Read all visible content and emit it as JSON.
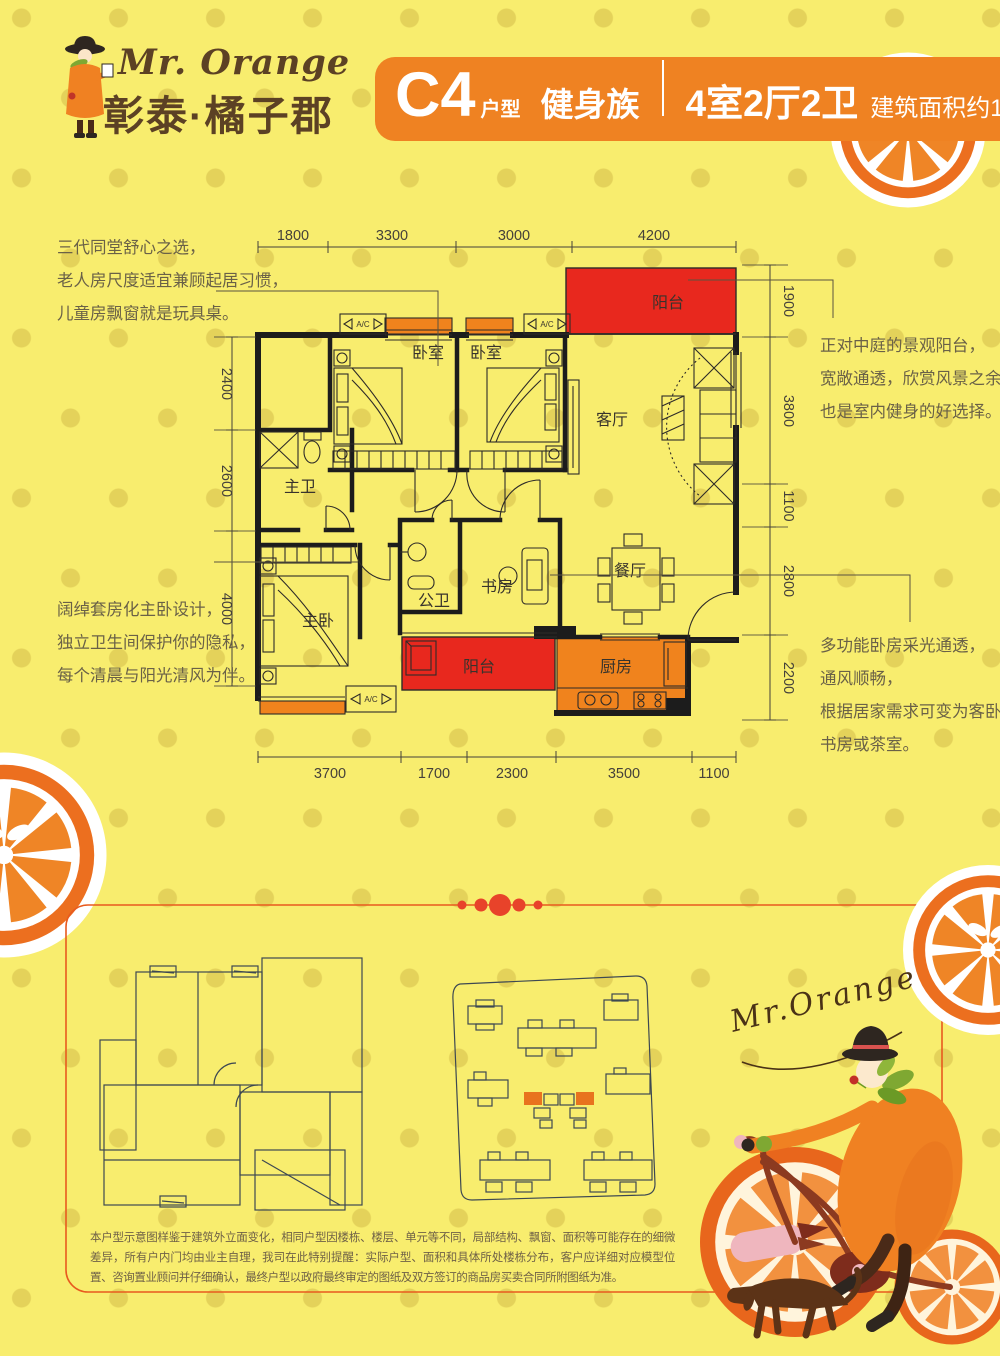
{
  "logo": {
    "brand_en": "Mr. Orange",
    "brand_cn": "彰泰·橘子郡"
  },
  "banner": {
    "unit": "C4",
    "unit_label": "户型",
    "tagline": "健身族",
    "spec": "4室2厅2卫",
    "area": "建筑面积约122 m",
    "area_sup": "2"
  },
  "floorplan": {
    "dims_top": [
      "1800",
      "3300",
      "3000",
      "4200"
    ],
    "dims_bottom": [
      "3700",
      "1700",
      "2300",
      "3500",
      "1100"
    ],
    "dims_left": [
      "2400",
      "2600",
      "4000"
    ],
    "dims_right": [
      "1900",
      "3800",
      "1100",
      "2800",
      "2200"
    ],
    "rooms": {
      "bedroom": "卧室",
      "living": "客厅",
      "master_bath": "主卫",
      "master_bed": "主卧",
      "public_bath": "公卫",
      "study": "书房",
      "dining": "餐厅",
      "balcony": "阳台",
      "kitchen": "厨房",
      "ac": "A/C"
    }
  },
  "annotations": {
    "top_left": [
      "三代同堂舒心之选，",
      "老人房尺度适宜兼顾起居习惯，",
      "儿童房飘窗就是玩具桌。"
    ],
    "bottom_left": [
      "阔绰套房化主卧设计，",
      "独立卫生间保护你的隐私，",
      "每个清晨与阳光清风为伴。"
    ],
    "top_right": [
      "正对中庭的景观阳台，",
      "宽敞通透，欣赏风景之余",
      "也是室内健身的好选择。"
    ],
    "bottom_right": [
      "多功能卧房采光通透，",
      "通风顺畅，",
      "根据居家需求可变为客卧、",
      "书房或茶室。"
    ]
  },
  "footer": {
    "signature": "Mr.Orange",
    "disclaimer": "本户型示意图样鉴于建筑外立面变化，相同户型因楼栋、楼层、单元等不同，局部结构、飘窗、面积等可能存在的细微差异，所有户内门均由业主自理，我司在此特别提醒：实际户型、面积和具体所处楼栋分布，客户应详细对应模型位置、咨询置业顾问并仔细确认，最终户型以政府最终审定的图纸及双方签订的商品房买卖合同所附图纸为准。"
  },
  "colors": {
    "background": "#F8ED6E",
    "dot": "#E4D25A",
    "accent_orange": "#EF8222",
    "accent_red": "#E8281E",
    "line_dark": "#1C1C1C",
    "text_brown": "#5C4124"
  }
}
